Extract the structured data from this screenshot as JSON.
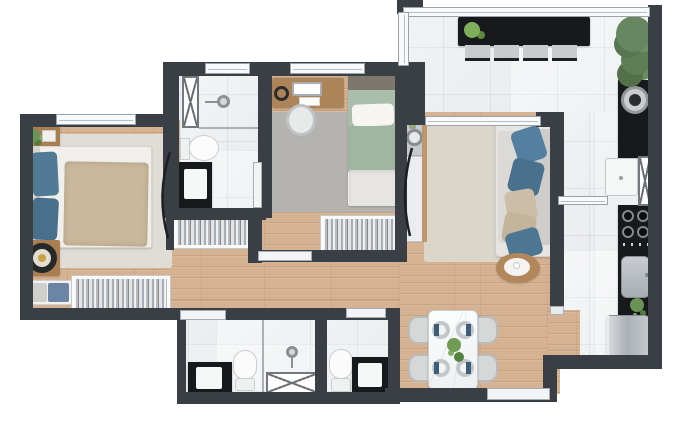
{
  "plan": {
    "label": "Apartment floor plan — top-down 3D render, no text labels",
    "canvas": {
      "width": 674,
      "height": 441
    },
    "palette": {
      "wall": "#3a3f46",
      "wood_floor": "#d5b291",
      "tile_floor": "#eef0f2",
      "counter_black": "#17191c",
      "accent_pillow_blue": "#4f7a96",
      "bed_green": "#a9bfab",
      "plant_green": "#6a9455",
      "stainless": "#b9bec2",
      "rug_beige": "#dbd6ca",
      "rug_gray": "#b5b3af"
    },
    "rooms": {
      "bedroom1": {
        "label": "Bedroom 1 — double bed, two nightstands, rug, wardrobe, bench",
        "furniture": [
          "double-bed",
          "nightstand-plant",
          "nightstand-lamp",
          "area-rug",
          "wardrobe",
          "bench-cushions"
        ]
      },
      "bathroom1": {
        "label": "Bathroom 1 — shower, toilet, black vanity, linen cabinet",
        "furniture": [
          "shower",
          "toilet",
          "vanity-sink",
          "hatched-cabinet"
        ]
      },
      "bedroom2": {
        "label": "Bedroom 2 — desk, office chair, single bed, rug, wardrobe",
        "furniture": [
          "desk-laptop",
          "office-chair",
          "single-bed",
          "area-rug",
          "wardrobe"
        ]
      },
      "hallway": {
        "label": "Hallway — built-in closet",
        "furniture": [
          "closet"
        ]
      },
      "bathroom2": {
        "label": "Bathroom 2 — vanity, toilet, shower box",
        "furniture": [
          "vanity-sink",
          "toilet",
          "shower-box"
        ]
      },
      "bathroom3": {
        "label": "Bathroom 3 — toilet, vanity",
        "furniture": [
          "toilet",
          "vanity-sink"
        ]
      },
      "living_room": {
        "label": "Living room — sofa with pillows, rug, side table, wash counter",
        "furniture": [
          "sofa",
          "area-rug",
          "side-table",
          "wash-counter"
        ]
      },
      "dining_room": {
        "label": "Dining area — marble table, four chairs, place settings, plant",
        "furniture": [
          "dining-table",
          "chairs",
          "plates",
          "plant-centerpiece"
        ]
      },
      "kitchen": {
        "label": "Kitchen — cooktop, counter, sink, plant, refrigerator",
        "furniture": [
          "cooktop",
          "counter",
          "sink",
          "plant",
          "refrigerator"
        ]
      },
      "balcony": {
        "label": "Terrace / balcony — bar counter, four stools, plants, round grill, washer, tall cabinet",
        "furniture": [
          "bar-counter",
          "bar-stools",
          "counter-plant",
          "corner-plant",
          "round-grill",
          "washer",
          "hatched-cabinet"
        ]
      }
    }
  }
}
